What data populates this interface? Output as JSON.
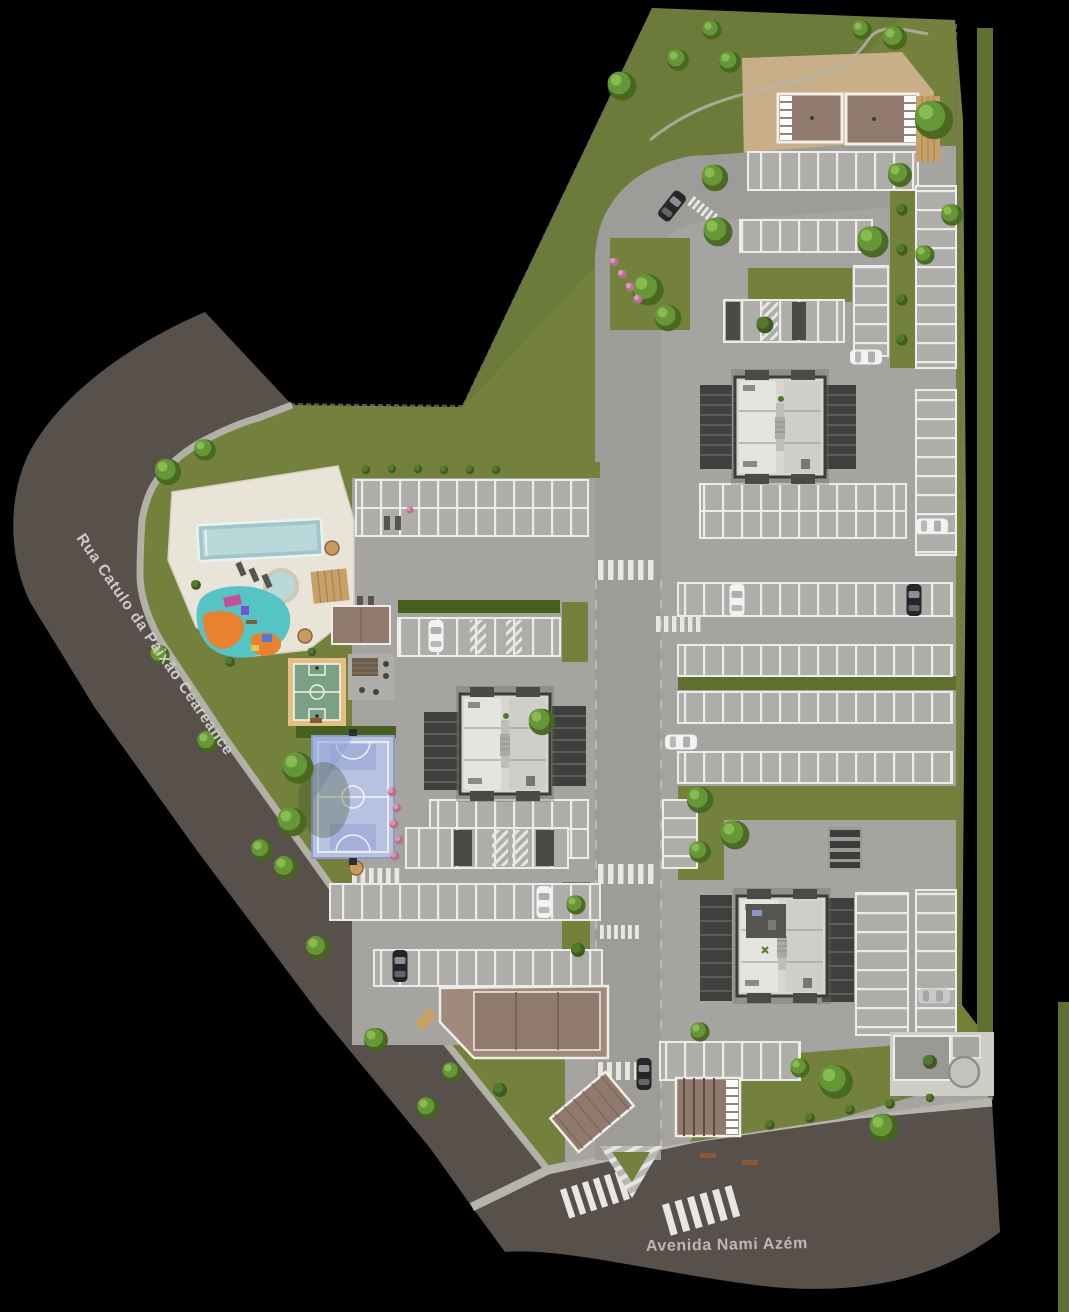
{
  "streets": {
    "left_label": "Rua Catulo da Paixão Ceareance",
    "bottom_label": "Avenida Nami Azém"
  },
  "visible_features": [
    "lap-pool",
    "kids-round-pool",
    "sun-deck",
    "playground",
    "basketball-court",
    "multisport-court",
    "barbecue-pergola",
    "apartment-block",
    "apartment-block",
    "apartment-block",
    "party-hall",
    "top-gatehouses",
    "bottom-gatehouse",
    "utility-building",
    "parking-lots",
    "internal-roads",
    "crosswalks",
    "traffic-island",
    "lawn",
    "trees"
  ],
  "colors": {
    "bg": "#000000",
    "grass": "#73813d",
    "grass2": "#5e6f2f",
    "hedge": "#46611f",
    "street": "#57504b",
    "walk": "#b7b3ad",
    "pave": "#a5a4a0",
    "pave2": "#aeadaa",
    "deck": "#e9e4d8",
    "water": "#9fc6cb",
    "water2": "#b9d8da",
    "courtg": "#7aa184",
    "courtt": "#e5be83",
    "courtb": "#b7c1e2",
    "teal": "#54c4c4",
    "orange": "#e8822e",
    "roof": "#8f7a6d",
    "roof2": "#a18a7b",
    "tan": "#cdb18b",
    "wood": "#c79f69",
    "label": "#cfccc7",
    "label2": "#bdb9b4",
    "carWhite": "#f2f2f0",
    "carDark": "#26262a",
    "carSilver": "#c9c9c7"
  }
}
